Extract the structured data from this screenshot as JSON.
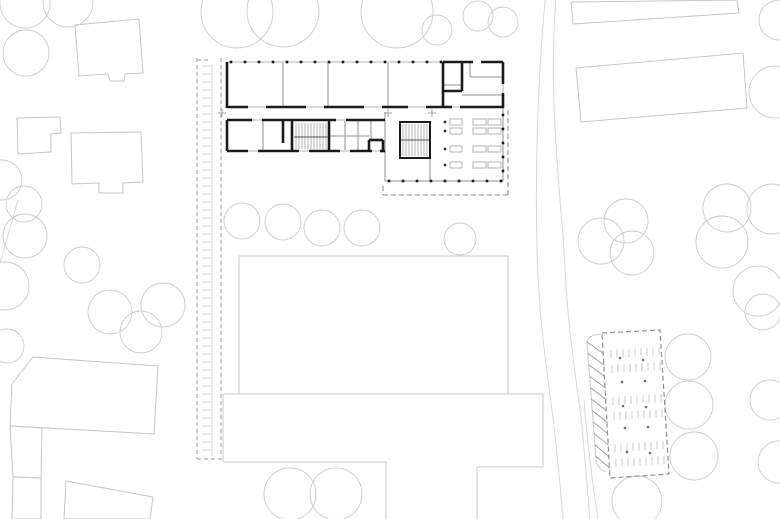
{
  "meta": {
    "canvas_width": 780,
    "canvas_height": 519,
    "drawing_kind": "architectural site plan with ground-floor plan"
  },
  "colors": {
    "background": "#ffffff",
    "wall": "#1a1a1a",
    "partition": "#8f8f8f",
    "window": "#b5b5b5",
    "neighbor": "#c5c5c5",
    "tree": "#cbcbcb",
    "field": "#c9c9c9",
    "road": "#d8d8d8",
    "boundary_dash": "#acacac",
    "boundary_tick": "#d0d0d0",
    "boundary_solid": "#d5d5d5",
    "parking_dash": "#8f8f8f",
    "stall": "#c9c9c9",
    "hatch": "#9a9a9a",
    "tread": "#b3b3b3",
    "furniture": "#b3b3b3",
    "column_dot": "#2a2a2a",
    "parking_dot": "#6e6e6e",
    "cross": "#9a9a9a"
  },
  "site": {
    "trees": [
      [
        237,
        12,
        36
      ],
      [
        283,
        11,
        36
      ],
      [
        397,
        12,
        36
      ],
      [
        437,
        30,
        15
      ],
      [
        478,
        16,
        15
      ],
      [
        503,
        22,
        15
      ],
      [
        25,
        3,
        25
      ],
      [
        68,
        2,
        25
      ],
      [
        26,
        53,
        23
      ],
      [
        2,
        180,
        20
      ],
      [
        24,
        204,
        18
      ],
      [
        25,
        236,
        22
      ],
      [
        5,
        286,
        24
      ],
      [
        82,
        265,
        18
      ],
      [
        110,
        312,
        22
      ],
      [
        141,
        332,
        21
      ],
      [
        163,
        305,
        22
      ],
      [
        7,
        346,
        17
      ],
      [
        290,
        494,
        26
      ],
      [
        336,
        494,
        26
      ],
      [
        242,
        221,
        18
      ],
      [
        283,
        222,
        18
      ],
      [
        322,
        228,
        18
      ],
      [
        362,
        228,
        18
      ],
      [
        460,
        239,
        16
      ],
      [
        626,
        221,
        22
      ],
      [
        601,
        241,
        23
      ],
      [
        632,
        253,
        22
      ],
      [
        727,
        208,
        24
      ],
      [
        722,
        242,
        26
      ],
      [
        772,
        209,
        25
      ],
      [
        758,
        291,
        25
      ],
      [
        779,
        20,
        20
      ],
      [
        775,
        92,
        26
      ],
      [
        688,
        357,
        23
      ],
      [
        689,
        405,
        24
      ],
      [
        694,
        456,
        24
      ],
      [
        763,
        312,
        18
      ],
      [
        770,
        400,
        20
      ],
      [
        779,
        462,
        21
      ],
      [
        637,
        501,
        25
      ]
    ],
    "neighbor_buildings": [
      [
        [
          75,
          25
        ],
        [
          139,
          19
        ],
        [
          143,
          73
        ],
        [
          125,
          74
        ],
        [
          124,
          81
        ],
        [
          110,
          81
        ],
        [
          108,
          74
        ],
        [
          79,
          76
        ]
      ],
      [
        [
          17,
          118
        ],
        [
          60,
          117
        ],
        [
          61,
          133
        ],
        [
          51,
          134
        ],
        [
          51,
          152
        ],
        [
          18,
          154
        ]
      ],
      [
        [
          71,
          133
        ],
        [
          141,
          132
        ],
        [
          143,
          182
        ],
        [
          123,
          183
        ],
        [
          123,
          193
        ],
        [
          99,
          193
        ],
        [
          99,
          183
        ],
        [
          72,
          184
        ]
      ],
      [
        [
          33,
          357
        ],
        [
          158,
          366
        ],
        [
          154,
          434
        ],
        [
          10,
          426
        ],
        [
          12,
          384
        ]
      ],
      [
        [
          10,
          426
        ],
        [
          42,
          428
        ],
        [
          41,
          478
        ],
        [
          13,
          477
        ]
      ],
      [
        [
          13,
          477
        ],
        [
          41,
          478
        ],
        [
          41,
          519
        ],
        [
          12,
          519
        ]
      ],
      [
        [
          66,
          481
        ],
        [
          153,
          497
        ],
        [
          150,
          519
        ],
        [
          64,
          519
        ]
      ],
      [
        [
          571,
          2
        ],
        [
          737,
          0
        ],
        [
          739,
          13
        ],
        [
          573,
          24
        ]
      ],
      [
        [
          576,
          68
        ],
        [
          743,
          53
        ],
        [
          747,
          108
        ],
        [
          581,
          122
        ]
      ]
    ],
    "roads": [
      "M545,0 C538,80 535,165 537,248 C539,330 549,382 554,426 C558,462 561,495 563,519",
      "M556,0 C549,80 557,165 564,248 C567,330 577,382 582,426 C585,462 588,495 590,519",
      "M584,400 C587,440 592,480 598,519",
      "M18,200 L0,263"
    ],
    "property_boundary": {
      "dashed_lines": [
        [
          197,
          58,
          197,
          459
        ],
        [
          221,
          58,
          221,
          455
        ],
        [
          197,
          60,
          211,
          60
        ],
        [
          197,
          459,
          222,
          459
        ]
      ],
      "ticks": {
        "x1": 202,
        "x2": 211,
        "y1": 66,
        "y2": 454,
        "step": 8
      },
      "solid_line": [
        212,
        64,
        212,
        456
      ]
    },
    "schoolyard": {
      "field_rect": [
        239,
        256,
        269,
        138
      ],
      "edges": [
        [
          223,
          394,
          543,
          394
        ],
        [
          223,
          394,
          223,
          462
        ],
        [
          223,
          462,
          386,
          462
        ],
        [
          386,
          462,
          386,
          519
        ],
        [
          543,
          394,
          543,
          467
        ],
        [
          543,
          467,
          477,
          467
        ],
        [
          477,
          467,
          477,
          519
        ]
      ]
    },
    "parking": {
      "dashed_outline": [
        [
          602,
          333
        ],
        [
          660,
          330
        ],
        [
          669,
          474
        ],
        [
          610,
          478
        ]
      ],
      "embankment_path": "M601,334 Q587,335 587,343 L596,459 Q597,469 606,472",
      "hatch": {
        "outer": [
          587,
          342,
          596,
          462
        ],
        "inner": [
          603,
          334,
          610,
          477
        ],
        "count": 11,
        "drop": 12
      },
      "stall_rows": [
        {
          "x": 611,
          "y": 350,
          "n": 9,
          "step": 6,
          "len": 8,
          "drift": -0.35
        },
        {
          "x": 612,
          "y": 365,
          "n": 9,
          "step": 6,
          "len": 8,
          "drift": -0.35
        },
        {
          "x": 613,
          "y": 397,
          "n": 9,
          "step": 6,
          "len": 8,
          "drift": -0.35
        },
        {
          "x": 614,
          "y": 412,
          "n": 9,
          "step": 6,
          "len": 8,
          "drift": -0.35
        },
        {
          "x": 615,
          "y": 444,
          "n": 9,
          "step": 6,
          "len": 8,
          "drift": -0.35
        },
        {
          "x": 616,
          "y": 459,
          "n": 9,
          "step": 6,
          "len": 8,
          "drift": -0.35
        }
      ],
      "tree_dots": [
        [
          620,
          358
        ],
        [
          643,
          360
        ],
        [
          622,
          382
        ],
        [
          645,
          381
        ],
        [
          623,
          406
        ],
        [
          646,
          407
        ],
        [
          625,
          428
        ],
        [
          648,
          427
        ],
        [
          627,
          452
        ],
        [
          650,
          453
        ]
      ]
    },
    "building": {
      "thin_base_lines": [
        [
          227,
          62,
          443,
          62
        ],
        [
          227,
          107,
          503,
          107
        ],
        [
          227,
          120,
          385,
          120
        ],
        [
          227,
          151,
          385,
          151
        ],
        [
          503,
          62,
          503,
          108
        ]
      ],
      "thick_walls": [
        [
          227,
          62,
          227,
          108
        ],
        [
          443,
          62,
          473,
          62
        ],
        [
          481,
          62,
          503,
          62
        ],
        [
          503,
          62,
          503,
          84
        ],
        [
          503,
          93,
          503,
          108
        ],
        [
          227,
          107,
          248,
          107
        ],
        [
          266,
          107,
          306,
          107
        ],
        [
          324,
          107,
          364,
          107
        ],
        [
          382,
          107,
          408,
          107
        ],
        [
          426,
          107,
          452,
          107
        ],
        [
          460,
          107,
          503,
          107
        ],
        [
          443,
          62,
          443,
          107
        ],
        [
          462,
          62,
          462,
          91
        ],
        [
          443,
          91,
          462,
          91
        ],
        [
          227,
          120,
          252,
          120
        ],
        [
          262,
          120,
          336,
          120
        ],
        [
          346,
          120,
          385,
          120
        ],
        [
          227,
          151,
          248,
          151
        ],
        [
          258,
          151,
          299,
          151
        ],
        [
          309,
          151,
          340,
          151
        ],
        [
          350,
          151,
          372,
          151
        ],
        [
          380,
          151,
          385,
          151
        ],
        [
          227,
          120,
          227,
          151
        ],
        [
          292,
          120,
          292,
          152
        ],
        [
          329,
          120,
          329,
          152
        ],
        [
          283,
          121,
          283,
          143
        ],
        [
          369,
          140,
          383,
          140
        ],
        [
          369,
          140,
          369,
          151
        ],
        [
          383,
          140,
          383,
          151
        ]
      ],
      "thin_walls": [
        [
          283,
          63,
          283,
          106
        ],
        [
          328,
          63,
          328,
          106
        ],
        [
          388,
          63,
          388,
          106
        ],
        [
          443,
          85,
          462,
          85
        ],
        [
          470,
          77,
          503,
          77
        ],
        [
          462,
          95,
          503,
          95
        ],
        [
          470,
          62,
          470,
          77
        ],
        [
          263,
          121,
          263,
          150
        ],
        [
          345,
          121,
          345,
          150
        ],
        [
          358,
          121,
          358,
          150
        ],
        [
          371,
          121,
          371,
          140
        ],
        [
          330,
          136,
          369,
          136
        ],
        [
          385,
          112,
          385,
          181
        ],
        [
          385,
          181,
          503,
          181
        ],
        [
          503,
          108,
          503,
          181
        ],
        [
          430,
          158,
          430,
          181
        ]
      ],
      "facade_posts": {
        "y": 62,
        "x1": 231,
        "x2": 441,
        "step": 14
      },
      "bottom_posts": {
        "y": 181,
        "x1": 389,
        "x2": 501,
        "step": 14
      },
      "right_posts": {
        "x": 503,
        "y1": 115,
        "y2": 177,
        "step": 14
      },
      "stairs": [
        {
          "treads": {
            "x1": 296,
            "x2": 326,
            "step": 3,
            "y1": 123,
            "y2": 149
          },
          "divider": [
            294,
            137,
            328,
            137
          ]
        },
        {
          "box": [
            400,
            122,
            30,
            36
          ],
          "treads": {
            "x1": 403,
            "x2": 427,
            "step": 3,
            "y1": 124,
            "y2": 156
          },
          "divider": [
            401,
            140,
            429,
            140
          ]
        }
      ],
      "hall_furniture": {
        "rows": [
          119,
          128,
          146,
          162
        ],
        "single_x": 450,
        "single_w": 12,
        "pair_x1": 473,
        "pair_x2": 488,
        "pair_w": 13,
        "h": 6
      },
      "column_dots": [
        [
          445,
          122
        ],
        [
          445,
          131
        ],
        [
          445,
          149
        ],
        [
          445,
          165
        ]
      ],
      "canopy_dashes": [
        [
          383,
          195,
          508,
          195
        ],
        [
          508,
          110,
          508,
          195
        ],
        [
          383,
          186,
          383,
          195
        ]
      ],
      "survey_crosses": [
        [
          222,
          113
        ],
        [
          388,
          113
        ],
        [
          432,
          113
        ]
      ]
    }
  }
}
